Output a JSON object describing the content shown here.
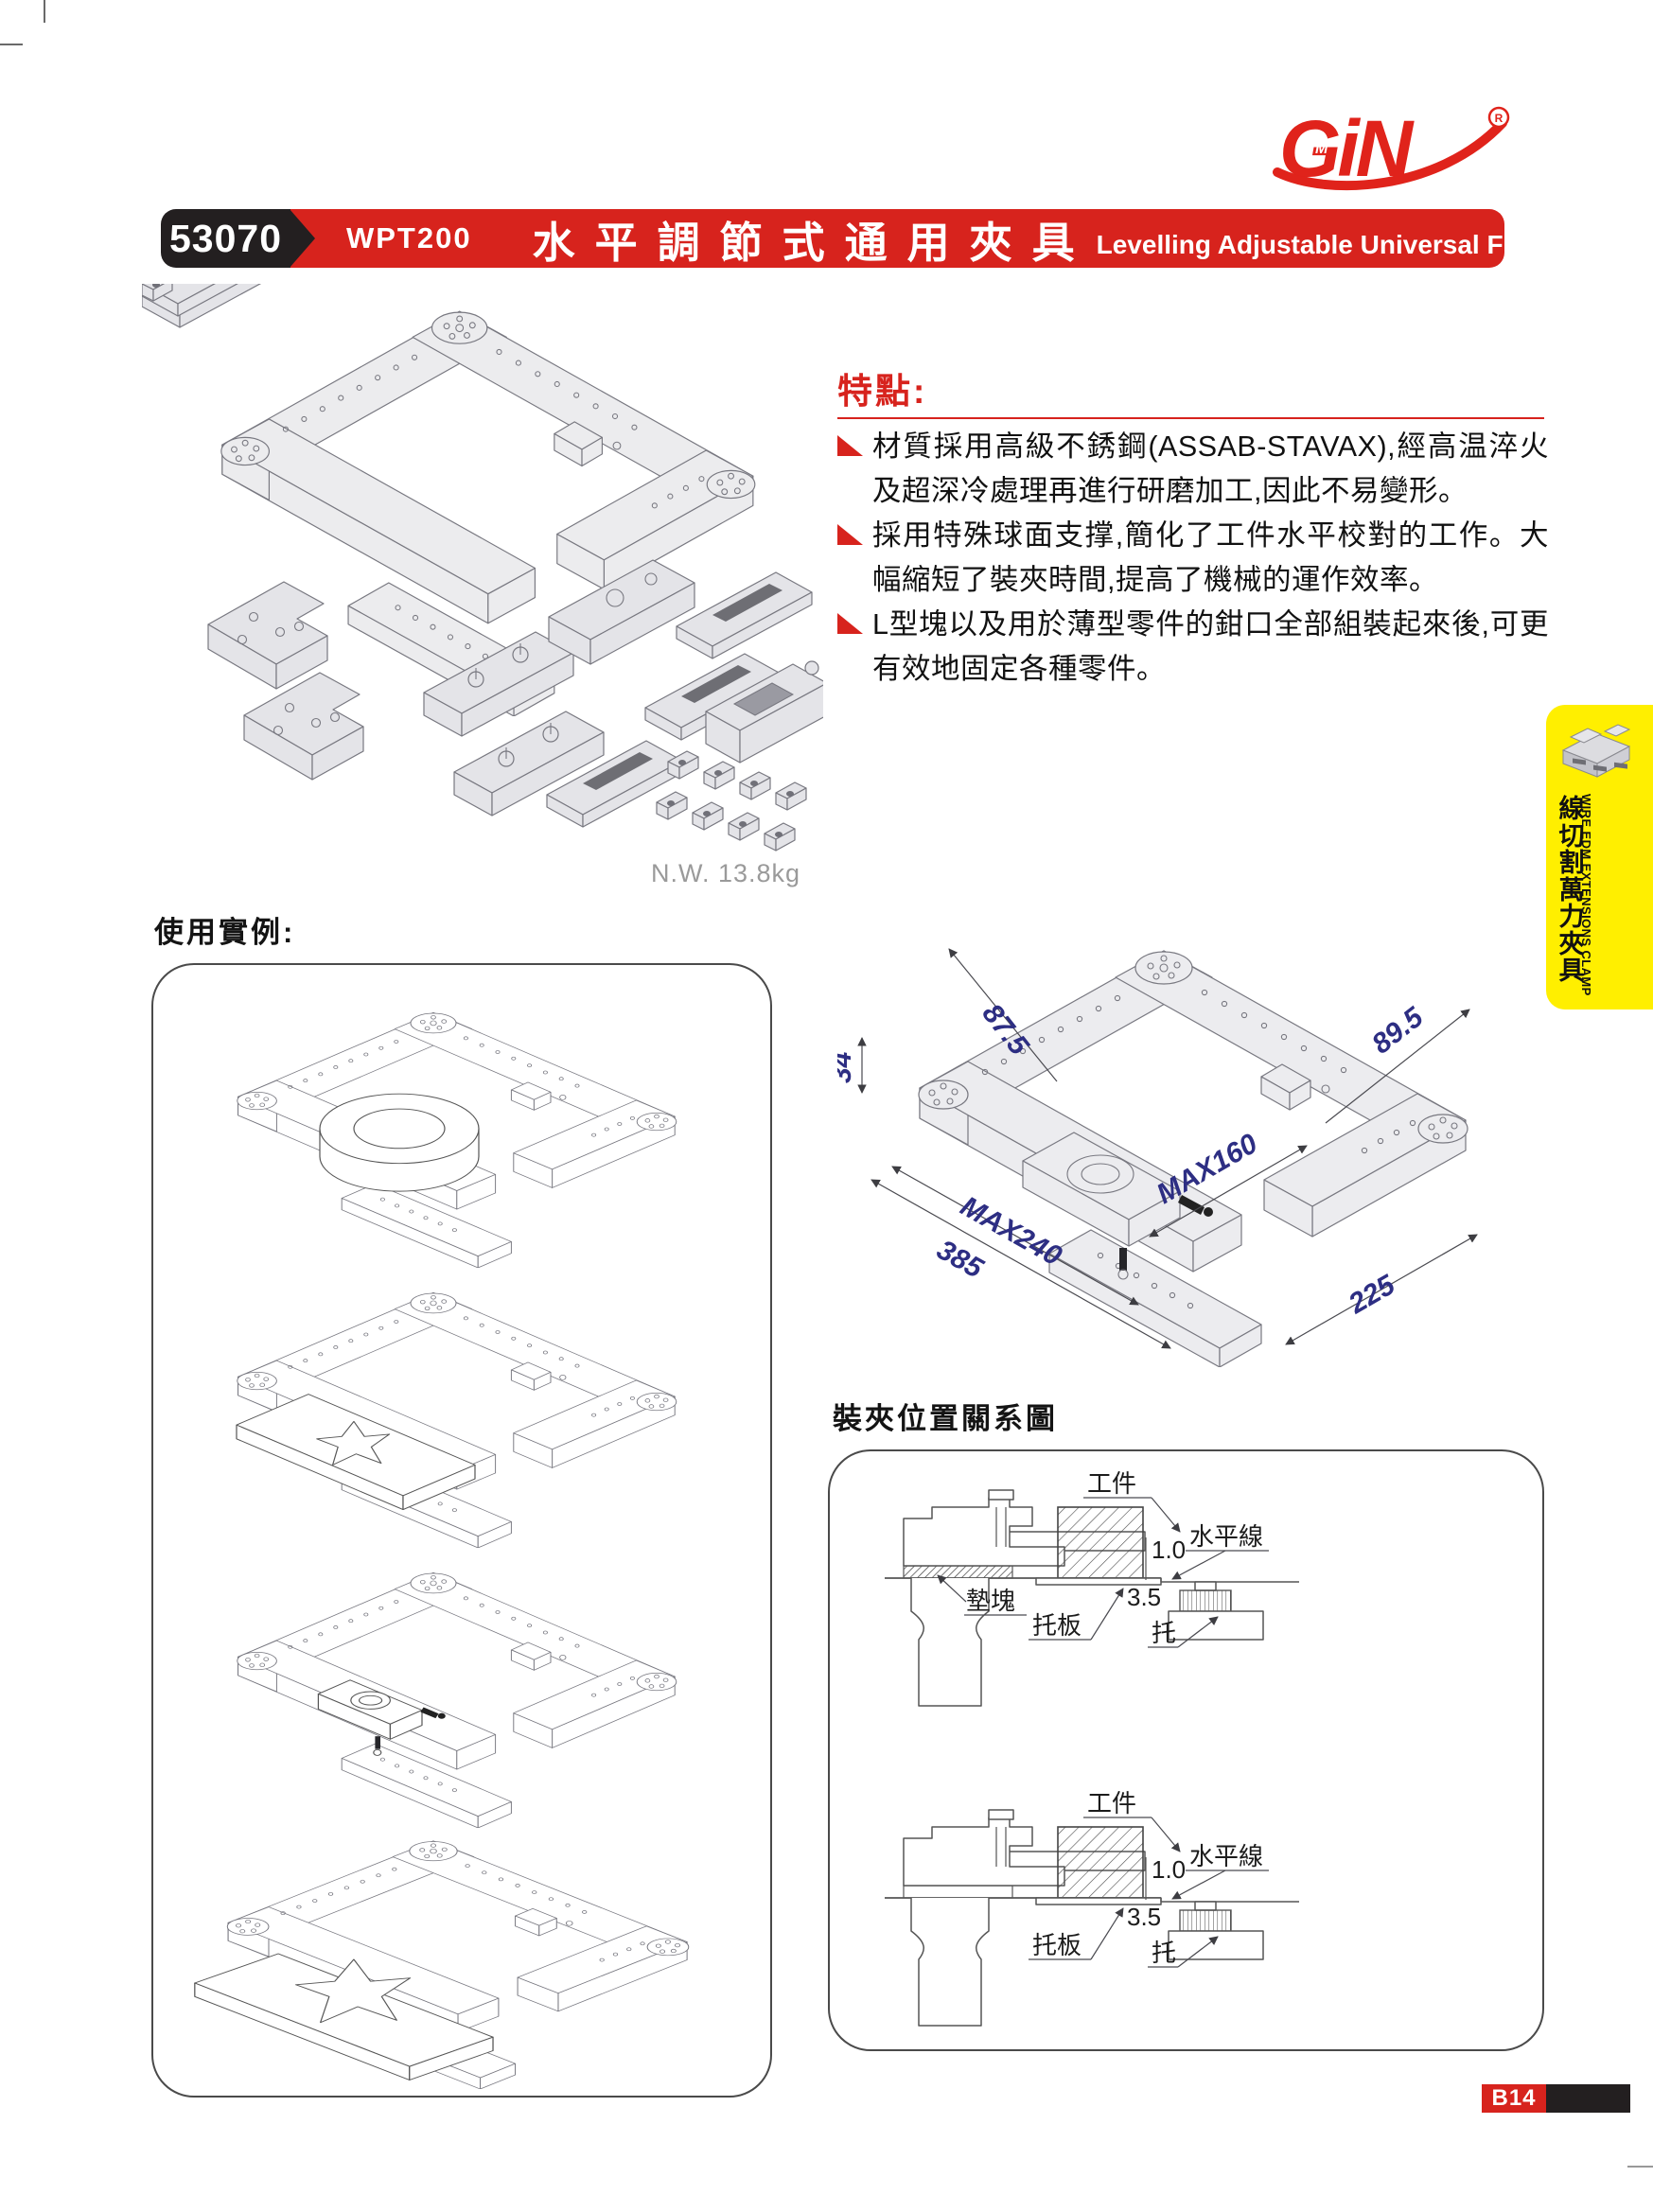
{
  "page": {
    "logo_text": "GiN",
    "logo_reg_mark": "R",
    "badge": "B14"
  },
  "header": {
    "code": "53070",
    "model": "WPT200",
    "title_zh": "水平調節式通用夾具",
    "title_en": "Levelling Adjustable Universal Fixture"
  },
  "product_photo": {
    "caption": "N.W. 13.8kg"
  },
  "features": {
    "heading": "特點:",
    "items": [
      {
        "text": "材質採用高級不銹鋼(ASSAB-STAVAX),經高温淬火及超深冷處理再進行研磨加工,因此不易變形。"
      },
      {
        "text": "採用特殊球面支撑,簡化了工件水平校對的工作。大幅縮短了裝夾時間,提高了機械的運作效率。"
      },
      {
        "text": "L型塊以及用於薄型零件的鉗口全部組裝起來後,可更有效地固定各種零件。"
      }
    ]
  },
  "side_tab": {
    "label_zh": "線切割萬力夾具",
    "label_en": "WIRE EDM EXTENSIONS CLAMP"
  },
  "usage_examples": {
    "heading": "使用實例:"
  },
  "dimension_drawing": {
    "dims": {
      "top_left": "87.5",
      "left_height": "34",
      "right_width": "89.5",
      "inner_max": "MAX160",
      "outer_max": "MAX240",
      "total_width": "385",
      "side_depth": "225"
    }
  },
  "clamp_position": {
    "heading": "裝夾位置關系圖",
    "labels": {
      "workpiece": "工件",
      "level_line": "水平線",
      "gap": "1.0",
      "offset": "3.5",
      "spacer": "墊塊",
      "plate": "托板",
      "support": "托"
    }
  },
  "colors": {
    "brand_red": "#d7231d",
    "tab_yellow": "#ffef00",
    "dim_blue": "#2d2e83",
    "badge_black": "#231f20"
  }
}
